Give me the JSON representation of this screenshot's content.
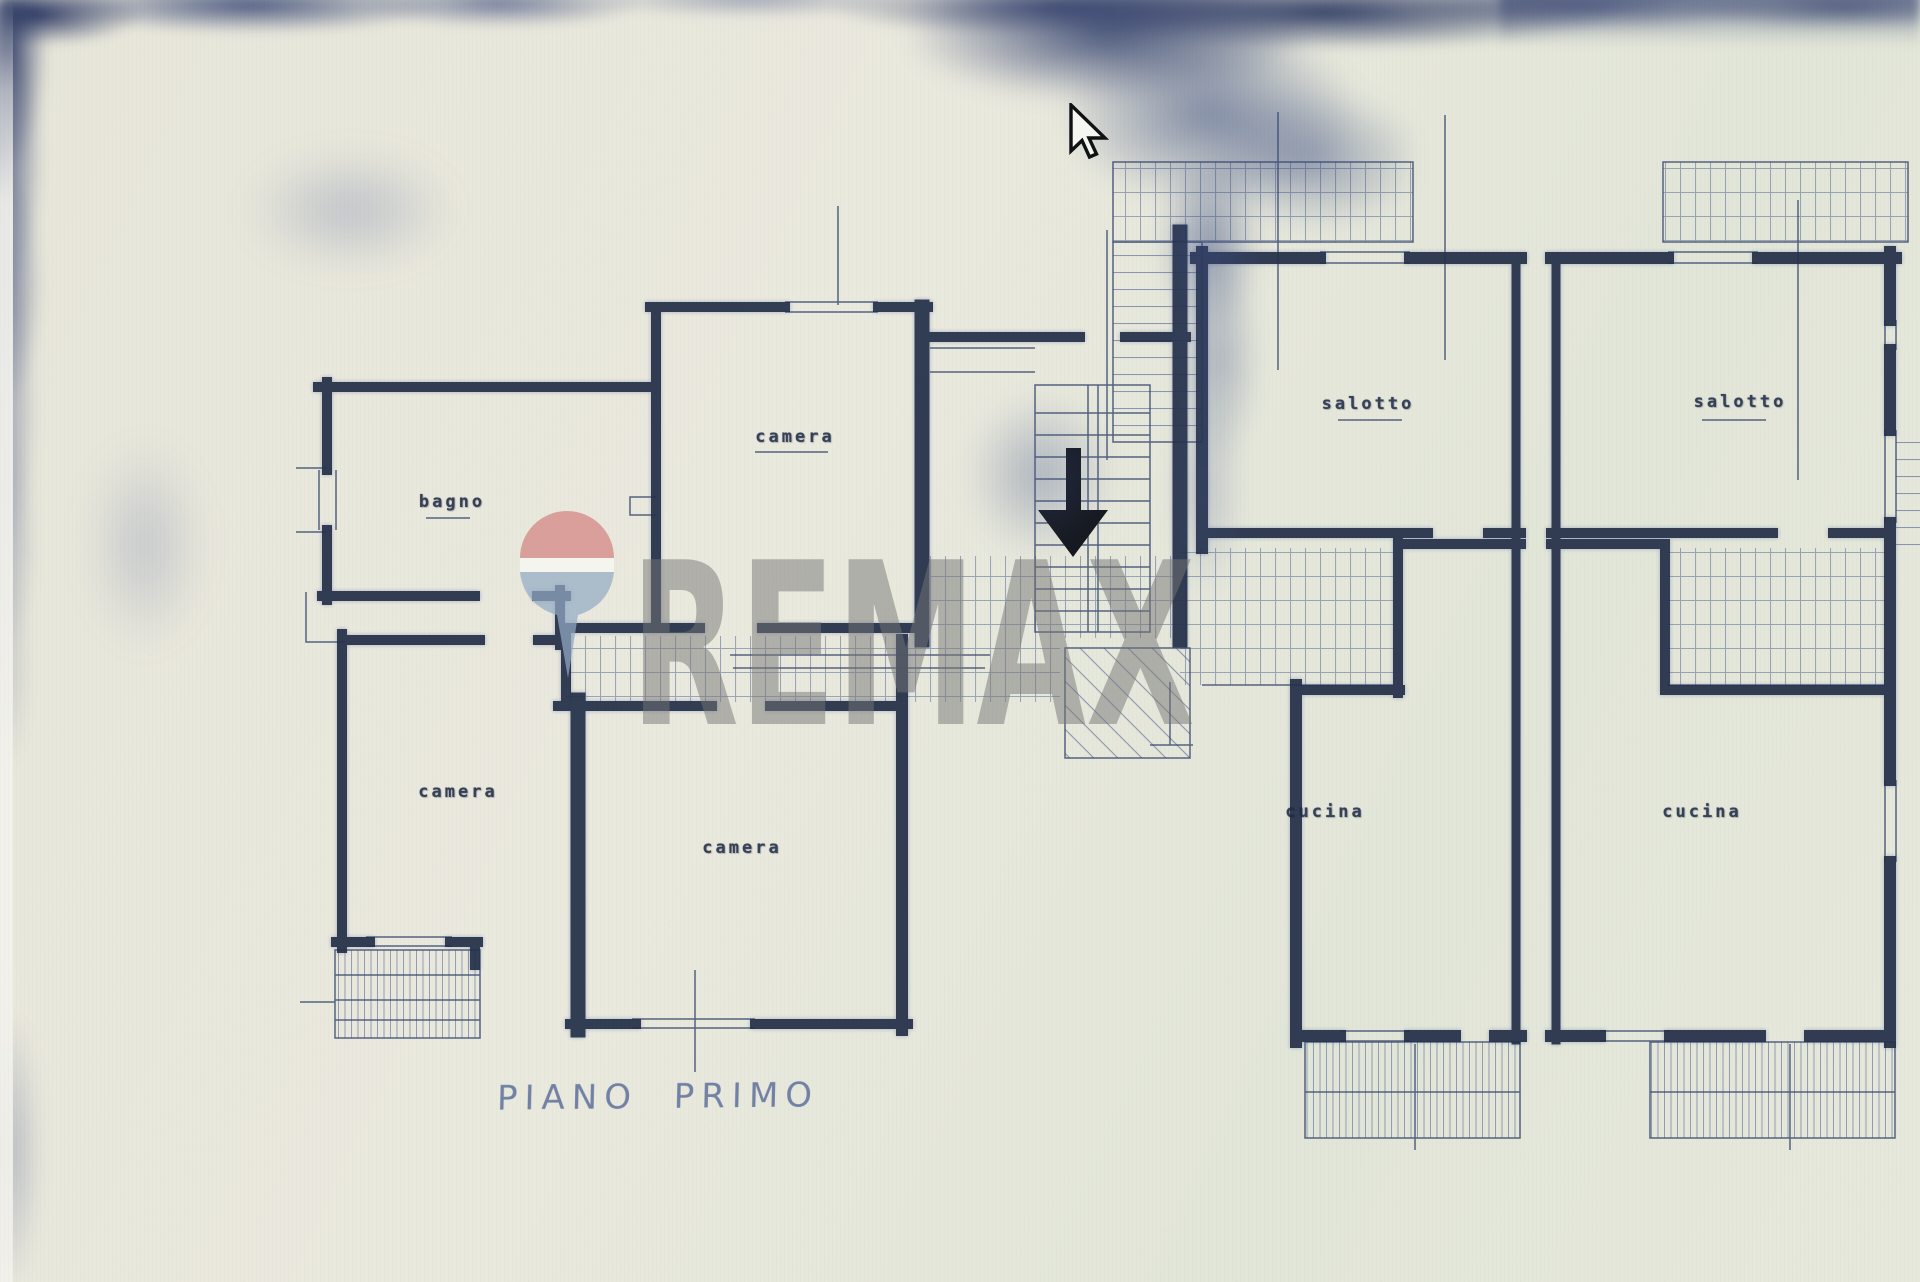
{
  "document": {
    "kind": "scanned blueprint floor plan",
    "caption": "PIANO PRIMO",
    "rooms": [
      {
        "id": "bagno",
        "label": "bagno"
      },
      {
        "id": "camera-top",
        "label": "camera"
      },
      {
        "id": "camera-left",
        "label": "camera"
      },
      {
        "id": "camera-middle",
        "label": "camera"
      },
      {
        "id": "salotto-left",
        "label": "salotto"
      },
      {
        "id": "salotto-right",
        "label": "salotto"
      },
      {
        "id": "cucina-left",
        "label": "cucina"
      },
      {
        "id": "cucina-right",
        "label": "cucina"
      }
    ],
    "stair_arrow_direction": "down"
  },
  "watermark": {
    "text": "REMAX",
    "text_color": "#787878",
    "balloon": {
      "top_color": "#d58a88",
      "band_color": "#f7f7f3",
      "bottom_color": "#93aac4"
    }
  },
  "cursor": {
    "type": "arrow-pointer"
  },
  "colors": {
    "paper": "#e8e7dc",
    "ink": "#243049",
    "hatch": "#4e6190",
    "noise": "#2c3a60",
    "caption_ink": "#66779f"
  }
}
